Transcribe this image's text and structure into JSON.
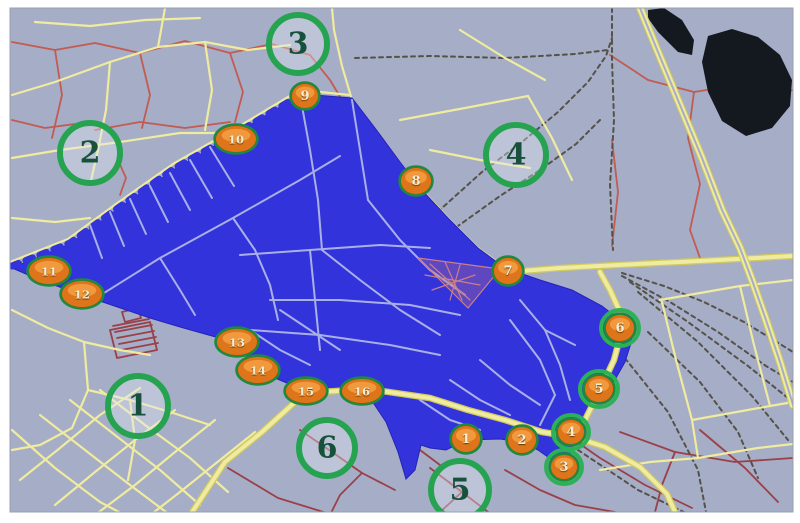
{
  "map": {
    "description": "GIS city map with highlighted blue district, 6 numbered green zone circles and 16 numbered orange station markers",
    "colors": {
      "background": "#a6adc6",
      "district_blue": "#3333dc",
      "district_edge": "#2424b8",
      "inner_street": "#a9b0e6",
      "road_yellow": "#efeb9f",
      "road_yellow_dark": "#d2c95f",
      "road_red": "#c25b52",
      "road_dark_red": "#9a4048",
      "rail": "#55524a",
      "water": "#14181f",
      "zone_ring": "#26a351",
      "zone_fill": "rgba(228,233,244,0.38)",
      "zone_text": "#17513b",
      "marker_base": "#a85408",
      "marker_mid": "#df751a",
      "marker_highlight": "#f5a044",
      "marker_ring": "#1d8a3f",
      "marker_halo": "#2cb157",
      "marker_text": "#f6ecd2",
      "frame": "#ffffff",
      "frame_line": "#9aa0ad",
      "mesh_pink": "#c97f8a"
    },
    "district_polygon": "12,268 70,244 118,209 175,169 235,134 270,113 302,94 352,98 378,132 400,162 420,188 448,218 478,248 505,268 540,280 572,290 602,306 620,320 632,340 625,362 612,385 600,392 586,422 575,436 566,468 552,460 538,450 522,442 500,439 466,440 446,450 430,448 421,445 415,470 406,479 398,452 386,422 374,404 362,392 306,391 258,371 237,343 180,327 150,318 82,295 40,280",
    "sawtooth_edge": "12,266 70,243 118,208 175,168 235,134 270,113 302,94",
    "water_bodies": [
      "648,10 664,8 682,20 694,40 692,55 678,52 658,32 648,18",
      "708,36 732,29 758,37 780,55 792,80 790,106 772,128 746,136 722,121 708,92 702,62"
    ],
    "triangle_mesh": {
      "fill_polygon": "418,258 500,269 468,308",
      "lines": [
        "418,258 500,269",
        "500,269 468,308",
        "468,308 418,258",
        "430,264 470,300",
        "445,262 462,300",
        "460,265 450,300",
        "425,275 480,285",
        "432,290 475,275"
      ]
    },
    "roads": {
      "yellow_thick": [
        "185,523 225,462 262,432 305,393 368,389 430,398 468,410 505,420 542,432 574,437 605,447 640,467 667,494 680,523",
        "508,272 560,268 618,265 700,261 793,256",
        "600,272 610,290 620,312 622,330 614,360 600,390 585,420 576,437"
      ],
      "yellow_highway": [
        "640,8 658,52 680,105 702,158 722,210 740,248 752,280 766,320 780,362 790,395 793,405"
      ],
      "yellow": [
        "508,270 478,248 448,218 420,188 392,156 368,124 352,100 342,66 334,30 332,8",
        "10,262 68,239 116,204 173,164 233,130 268,109 300,90 350,95",
        "12,95 55,82 110,62 158,47 205,42 248,50 290,45",
        "110,62 106,110 98,150 90,185",
        "12,158 60,150 120,142 180,133 235,133",
        "158,47 165,8",
        "205,42 212,90 205,130",
        "35,22 90,26 145,20 200,18",
        "12,218 55,222 90,218",
        "12,310 48,328 84,342 88,390 72,428 40,445 12,450",
        "84,342 120,350 150,355",
        "88,390 130,400 170,412 210,425",
        "130,400 135,440 128,480",
        "12,430 55,468 100,502 140,523",
        "40,415 85,450 130,485 170,515",
        "70,400 115,435 160,470 200,505",
        "100,390 145,425 190,458 228,492",
        "20,480 60,448 100,415 140,388",
        "55,505 95,472 135,440 175,410",
        "95,515 135,485 175,452 215,420",
        "140,523 180,492 220,460 255,432",
        "660,300 740,286 793,280",
        "662,302 676,360 692,420 698,458",
        "692,420 770,406 793,402",
        "740,286 754,345 770,406",
        "698,458 758,448 793,444",
        "600,470 650,462 698,458",
        "400,120 465,108 528,96",
        "528,96 552,138 572,180",
        "430,150 480,160 530,168",
        "460,30 505,58 545,80"
      ],
      "red": [
        "12,42 55,50 95,43 140,53 185,41 230,53 272,44 310,55",
        "55,50 62,95 52,138",
        "140,53 150,95 142,128",
        "230,53 243,92 235,122",
        "95,130 140,122 185,128 230,122",
        "12,120 45,128 75,124",
        "310,55 330,80 345,105",
        "118,160 126,178 120,195",
        "610,55 648,80 694,92 732,86 770,96 793,90",
        "694,92 688,138 700,184 690,230 700,258",
        "612,140 618,192 612,246"
      ],
      "dark_red": [
        "228,468 278,498 330,514 380,520",
        "300,430 332,452 362,473 395,490",
        "362,473 340,495 330,515",
        "430,468 462,492 488,512",
        "462,492 440,512",
        "505,470 540,490 575,505 615,512",
        "560,430 600,458 645,485 692,508",
        "620,432 675,452 735,462 793,458",
        "675,452 662,485 655,512",
        "700,430 745,468 778,502",
        "398,430 420,450 440,465",
        "115,332 152,325",
        "117,338 154,331",
        "119,344 156,337",
        "121,350 158,343",
        "113,326 149,319",
        "110,330 150,322 157,350 117,358 110,330",
        "122,312 138,308 141,318 125,322 122,312"
      ],
      "rail": [
        "612,8 612,60 614,120 610,185 613,250",
        "405,247 442,208 482,172 522,142 558,112 588,82 606,56 612,38",
        "418,256 458,226 500,196 540,170 576,144 600,120",
        "355,58 430,56 505,58 575,54 608,50",
        "622,273 664,286 704,302 744,322 780,344 793,352",
        "622,276 670,302 718,332 766,366 793,382",
        "630,282 688,322 748,366 793,402",
        "638,292 698,342 752,396 788,440",
        "648,332 700,382 738,432 758,478",
        "620,352 668,412 698,470 706,512",
        "578,450 638,490 688,514"
      ],
      "inner_streets": [
        "88,303 160,258 233,218 300,180 340,156",
        "90,225 102,258",
        "110,212 124,246",
        "130,199 146,234",
        "150,186 168,222",
        "170,173 190,210",
        "190,160 212,198",
        "210,147 234,186",
        "233,218 255,250 270,285 278,320",
        "160,258 180,290 195,315",
        "240,255 310,250 380,245 430,248",
        "310,250 315,300 320,350",
        "270,300 340,300 410,305 460,315",
        "250,330 320,335 390,345 440,355",
        "300,95 310,150 318,200 322,250",
        "352,100 360,150 368,200",
        "322,250 360,280 400,310 440,335",
        "368,200 400,240 430,270 465,295",
        "520,300 545,330 560,365 570,400",
        "545,330 575,345",
        "510,320 540,360 555,395",
        "555,395 540,425",
        "420,400 450,420 480,430",
        "450,380 480,400 510,415",
        "480,360 510,385 540,405",
        "250,330 280,350 310,365",
        "280,310 310,330 340,350"
      ]
    },
    "zones": [
      {
        "n": "1",
        "x": 138,
        "y": 406,
        "r": 30
      },
      {
        "n": "2",
        "x": 90,
        "y": 153,
        "r": 30
      },
      {
        "n": "3",
        "x": 298,
        "y": 44,
        "r": 29
      },
      {
        "n": "4",
        "x": 516,
        "y": 155,
        "r": 30
      },
      {
        "n": "5",
        "x": 460,
        "y": 490,
        "r": 29
      },
      {
        "n": "6",
        "x": 327,
        "y": 448,
        "r": 28
      }
    ],
    "markers": [
      {
        "n": "1",
        "x": 466,
        "y": 439,
        "rx": 14,
        "ry": 13,
        "halo": false
      },
      {
        "n": "2",
        "x": 522,
        "y": 440,
        "rx": 14,
        "ry": 13,
        "halo": false
      },
      {
        "n": "3",
        "x": 564,
        "y": 467,
        "rx": 13,
        "ry": 12,
        "halo": true
      },
      {
        "n": "4",
        "x": 571,
        "y": 432,
        "rx": 13,
        "ry": 12,
        "halo": true
      },
      {
        "n": "5",
        "x": 599,
        "y": 389,
        "rx": 14,
        "ry": 13,
        "halo": true
      },
      {
        "n": "6",
        "x": 620,
        "y": 328,
        "rx": 14,
        "ry": 13,
        "halo": true
      },
      {
        "n": "7",
        "x": 508,
        "y": 271,
        "rx": 14,
        "ry": 13,
        "halo": false
      },
      {
        "n": "8",
        "x": 416,
        "y": 181,
        "rx": 15,
        "ry": 13,
        "halo": false
      },
      {
        "n": "9",
        "x": 305,
        "y": 96,
        "rx": 13,
        "ry": 12,
        "halo": false
      },
      {
        "n": "10",
        "x": 236,
        "y": 139,
        "rx": 20,
        "ry": 13,
        "halo": false
      },
      {
        "n": "11",
        "x": 49,
        "y": 271,
        "rx": 20,
        "ry": 13,
        "halo": false
      },
      {
        "n": "12",
        "x": 82,
        "y": 294,
        "rx": 20,
        "ry": 13,
        "halo": false
      },
      {
        "n": "13",
        "x": 237,
        "y": 342,
        "rx": 20,
        "ry": 13,
        "halo": false
      },
      {
        "n": "14",
        "x": 258,
        "y": 370,
        "rx": 20,
        "ry": 13,
        "halo": false
      },
      {
        "n": "15",
        "x": 306,
        "y": 391,
        "rx": 20,
        "ry": 12,
        "halo": false
      },
      {
        "n": "16",
        "x": 362,
        "y": 391,
        "rx": 20,
        "ry": 12,
        "halo": false
      }
    ],
    "frame": {
      "left": 10,
      "top": 8,
      "right": 793,
      "bottom": 512
    }
  }
}
